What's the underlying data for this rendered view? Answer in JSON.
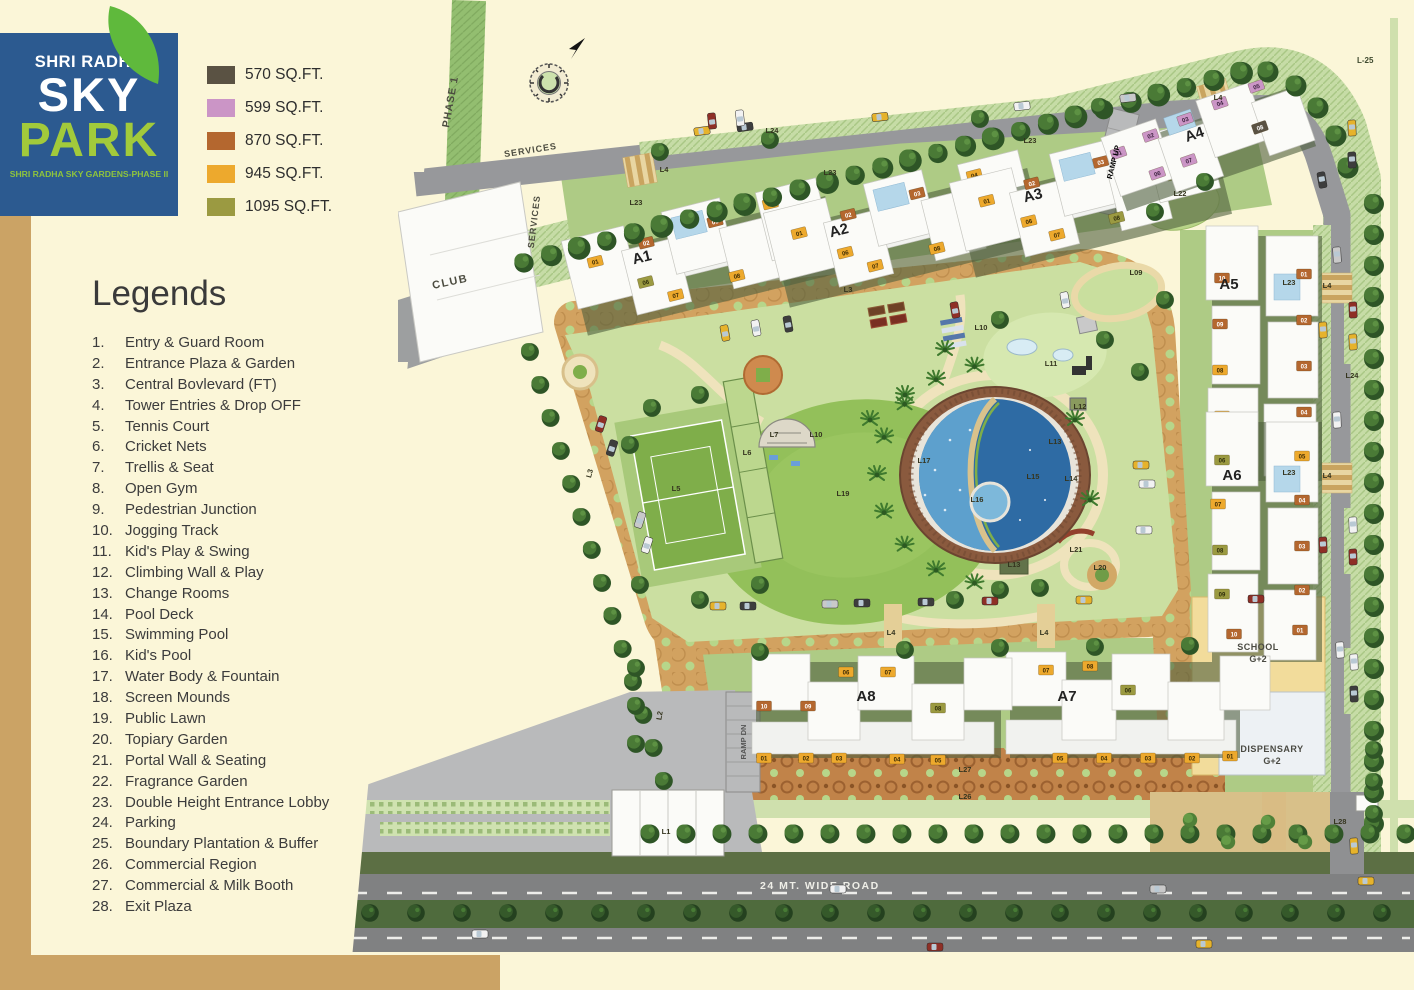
{
  "logo": {
    "brand": "SHRI RADHA",
    "title": "SKY",
    "title2": "PARK",
    "subtitle": "SHRI RADHA SKY GARDENS-PHASE II",
    "bg": "#2C5A90",
    "accent": "#A2CA3B"
  },
  "size_legend": [
    {
      "label": "570 SQ.FT.",
      "color": "#5A5243"
    },
    {
      "label": "599 SQ.FT.",
      "color": "#CB95C6"
    },
    {
      "label": "870 SQ.FT.",
      "color": "#B4672F"
    },
    {
      "label": "945 SQ.FT.",
      "color": "#EDA92D"
    },
    {
      "label": "1095 SQ.FT.",
      "color": "#9B9A41"
    }
  ],
  "legends": {
    "title": "Legends",
    "items": [
      {
        "num": "1.",
        "label": "Entry & Guard Room"
      },
      {
        "num": "2.",
        "label": "Entrance Plaza & Garden"
      },
      {
        "num": "3.",
        "label": "Central Bovlevard (FT)"
      },
      {
        "num": "4.",
        "label": "Tower Entries & Drop OFF"
      },
      {
        "num": "5.",
        "label": "Tennis Court"
      },
      {
        "num": "6.",
        "label": "Cricket Nets"
      },
      {
        "num": "7.",
        "label": "Trellis & Seat"
      },
      {
        "num": "8.",
        "label": "Open Gym"
      },
      {
        "num": "9.",
        "label": "Pedestrian Junction"
      },
      {
        "num": "10.",
        "label": "Jogging Track"
      },
      {
        "num": "11.",
        "label": "Kid's Play & Swing"
      },
      {
        "num": "12.",
        "label": "Climbing Wall & Play"
      },
      {
        "num": "13.",
        "label": "Change Rooms"
      },
      {
        "num": "14.",
        "label": "Pool Deck"
      },
      {
        "num": "15.",
        "label": "Swimming Pool"
      },
      {
        "num": "16.",
        "label": "Kid's Pool"
      },
      {
        "num": "17.",
        "label": "Water Body & Fountain"
      },
      {
        "num": "18.",
        "label": "Screen Mounds"
      },
      {
        "num": "19.",
        "label": "Public Lawn"
      },
      {
        "num": "20.",
        "label": "Topiary Garden"
      },
      {
        "num": "21.",
        "label": "Portal Wall & Seating"
      },
      {
        "num": "22.",
        "label": "Fragrance Garden"
      },
      {
        "num": "23.",
        "label": "Double Height Entrance Lobby"
      },
      {
        "num": "24.",
        "label": "Parking"
      },
      {
        "num": "25.",
        "label": "Boundary Plantation & Buffer"
      },
      {
        "num": "26.",
        "label": "Commercial Region"
      },
      {
        "num": "27.",
        "label": "Commercial & Milk Booth"
      },
      {
        "num": "28.",
        "label": "Exit Plaza"
      }
    ]
  },
  "map": {
    "labels": {
      "phase1": "PHASE 1",
      "services_top": "SERVICES",
      "services_side": "SERVICES",
      "club": "CLUB",
      "ramp_up": "RAMP UP",
      "ramp_dn": "RAMP DN",
      "wide_road": "24 MT. WIDE ROAD",
      "school_line1": "SCHOOL",
      "school_line2": "G+2",
      "dispensary_line1": "DISPENSARY",
      "dispensary_line2": "G+2",
      "boundary": "L-25"
    },
    "building_labels": [
      {
        "t": "A1",
        "x": 643,
        "y": 262,
        "r": -14
      },
      {
        "t": "A2",
        "x": 840,
        "y": 235,
        "r": -14
      },
      {
        "t": "A3",
        "x": 1034,
        "y": 200,
        "r": -14
      },
      {
        "t": "A4",
        "x": 1196,
        "y": 139,
        "r": -19
      },
      {
        "t": "A5",
        "x": 1229,
        "y": 289,
        "r": 0
      },
      {
        "t": "A6",
        "x": 1232,
        "y": 480,
        "r": 0
      },
      {
        "t": "A7",
        "x": 1067,
        "y": 701,
        "r": 0
      },
      {
        "t": "A8",
        "x": 866,
        "y": 701,
        "r": 0
      }
    ],
    "l_labels": [
      {
        "t": "L23",
        "x": 636,
        "y": 205
      },
      {
        "t": "L4",
        "x": 664,
        "y": 172
      },
      {
        "t": "L24",
        "x": 772,
        "y": 133
      },
      {
        "t": "L23",
        "x": 830,
        "y": 175
      },
      {
        "t": "L3",
        "x": 848,
        "y": 292
      },
      {
        "t": "L23",
        "x": 1030,
        "y": 143
      },
      {
        "t": "L4",
        "x": 1218,
        "y": 100
      },
      {
        "t": "L22",
        "x": 1180,
        "y": 196
      },
      {
        "t": "L09",
        "x": 1136,
        "y": 275
      },
      {
        "t": "L23",
        "x": 1289,
        "y": 285
      },
      {
        "t": "L4",
        "x": 1327,
        "y": 288
      },
      {
        "t": "L24",
        "x": 1352,
        "y": 378
      },
      {
        "t": "L10",
        "x": 981,
        "y": 330
      },
      {
        "t": "L11",
        "x": 1051,
        "y": 366
      },
      {
        "t": "L12",
        "x": 1080,
        "y": 409
      },
      {
        "t": "L13",
        "x": 1055,
        "y": 444
      },
      {
        "t": "L14",
        "x": 1071,
        "y": 481
      },
      {
        "t": "L15",
        "x": 1033,
        "y": 479
      },
      {
        "t": "L16",
        "x": 977,
        "y": 502
      },
      {
        "t": "L17",
        "x": 924,
        "y": 463
      },
      {
        "t": "L19",
        "x": 843,
        "y": 496
      },
      {
        "t": "L7",
        "x": 774,
        "y": 437
      },
      {
        "t": "L10",
        "x": 816,
        "y": 437
      },
      {
        "t": "L5",
        "x": 676,
        "y": 491
      },
      {
        "t": "L6",
        "x": 747,
        "y": 455
      },
      {
        "t": "L20",
        "x": 1100,
        "y": 570
      },
      {
        "t": "L21",
        "x": 1076,
        "y": 552
      },
      {
        "t": "L13",
        "x": 1014,
        "y": 567
      },
      {
        "t": "L23",
        "x": 1289,
        "y": 475
      },
      {
        "t": "L4",
        "x": 1327,
        "y": 478
      },
      {
        "t": "L3",
        "x": 592,
        "y": 474,
        "r": -75
      },
      {
        "t": "L2",
        "x": 662,
        "y": 716,
        "r": -80
      },
      {
        "t": "L4",
        "x": 891,
        "y": 635
      },
      {
        "t": "L4",
        "x": 1044,
        "y": 635
      },
      {
        "t": "L27",
        "x": 965,
        "y": 772
      },
      {
        "t": "L26",
        "x": 965,
        "y": 799
      },
      {
        "t": "L1",
        "x": 666,
        "y": 834
      },
      {
        "t": "L28",
        "x": 1340,
        "y": 824
      }
    ],
    "buildings": [
      {
        "name": "A1",
        "badges": [
          [
            "01",
            "amber",
            -104,
            -16
          ],
          [
            "02",
            "rust",
            -50,
            -22
          ],
          [
            "03",
            "rust",
            22,
            -26
          ],
          [
            "04",
            "amber",
            80,
            -30
          ],
          [
            "05",
            "olive",
            92,
            4
          ],
          [
            "06",
            "olive",
            -60,
            16
          ],
          [
            "07",
            "amber",
            -34,
            36
          ],
          [
            "08",
            "amber",
            30,
            32
          ]
        ]
      },
      {
        "name": "A2",
        "badges": [
          [
            "01",
            "amber",
            -102,
            -16
          ],
          [
            "02",
            "rust",
            -50,
            -22
          ],
          [
            "03",
            "rust",
            22,
            -26
          ],
          [
            "04",
            "amber",
            82,
            -30
          ],
          [
            "05",
            "olive",
            92,
            4
          ],
          [
            "06",
            "amber",
            -62,
            14
          ],
          [
            "07",
            "amber",
            -36,
            34
          ],
          [
            "08",
            "amber",
            28,
            32
          ]
        ]
      },
      {
        "name": "A3",
        "badges": [
          [
            "01",
            "amber",
            -100,
            -18
          ],
          [
            "02",
            "rust",
            -52,
            -24
          ],
          [
            "03",
            "rust",
            20,
            -28
          ],
          [
            "04",
            "amber",
            78,
            -32
          ],
          [
            "05",
            "olive",
            88,
            2
          ],
          [
            "06",
            "amber",
            -64,
            12
          ],
          [
            "07",
            "amber",
            -40,
            32
          ],
          [
            "08",
            "olive",
            22,
            30
          ]
        ]
      },
      {
        "name": "A4",
        "badges": [
          [
            "01",
            "pink",
            -86,
            -16
          ],
          [
            "02",
            "pink",
            -50,
            -22
          ],
          [
            "03",
            "pink",
            -12,
            -26
          ],
          [
            "04",
            "pink",
            26,
            -30
          ],
          [
            "05",
            "pink",
            66,
            -34
          ],
          [
            "06",
            "pink",
            -56,
            16
          ],
          [
            "07",
            "pink",
            -22,
            14
          ],
          [
            "08",
            "dark",
            56,
            6
          ]
        ]
      },
      {
        "name": "A5",
        "badges": [
          [
            "10",
            "rust",
            -40,
            -74
          ],
          [
            "01",
            "rust",
            42,
            -78
          ],
          [
            "09",
            "rust",
            -42,
            -28
          ],
          [
            "02",
            "rust",
            42,
            -32
          ],
          [
            "08",
            "amber",
            -42,
            18
          ],
          [
            "03",
            "rust",
            42,
            14
          ],
          [
            "07",
            "amber",
            -40,
            64
          ],
          [
            "04",
            "rust",
            42,
            60
          ],
          [
            "06",
            "olive",
            -28,
            106
          ],
          [
            "05",
            "amber",
            36,
            102
          ]
        ]
      },
      {
        "name": "A6",
        "badges": [
          [
            "06",
            "olive",
            -40,
            -72
          ],
          [
            "05",
            "amber",
            40,
            -76
          ],
          [
            "07",
            "amber",
            -44,
            -28
          ],
          [
            "04",
            "rust",
            40,
            -32
          ],
          [
            "08",
            "olive",
            -42,
            18
          ],
          [
            "03",
            "rust",
            40,
            14
          ],
          [
            "09",
            "olive",
            -40,
            62
          ],
          [
            "02",
            "rust",
            40,
            58
          ],
          [
            "10",
            "rust",
            -28,
            102
          ],
          [
            "01",
            "rust",
            38,
            98
          ]
        ]
      },
      {
        "name": "A7",
        "badges": [
          [
            "07",
            "amber",
            -72,
            -30
          ],
          [
            "08",
            "amber",
            -28,
            -34
          ],
          [
            "06",
            "olive",
            10,
            -10
          ],
          [
            "05",
            "amber",
            -58,
            58
          ],
          [
            "04",
            "amber",
            -14,
            58
          ],
          [
            "03",
            "amber",
            30,
            58
          ],
          [
            "02",
            "amber",
            74,
            58
          ],
          [
            "01",
            "amber",
            112,
            56
          ]
        ]
      },
      {
        "name": "A8",
        "badges": [
          [
            "06",
            "amber",
            -26,
            -28
          ],
          [
            "07",
            "amber",
            16,
            -28
          ],
          [
            "10",
            "rust",
            -108,
            6
          ],
          [
            "09",
            "rust",
            -64,
            6
          ],
          [
            "08",
            "olive",
            66,
            8
          ],
          [
            "01",
            "amber",
            -108,
            58
          ],
          [
            "02",
            "amber",
            -66,
            58
          ],
          [
            "03",
            "amber",
            -33,
            58
          ],
          [
            "04",
            "amber",
            25,
            59
          ],
          [
            "05",
            "amber",
            66,
            60
          ]
        ]
      }
    ]
  }
}
